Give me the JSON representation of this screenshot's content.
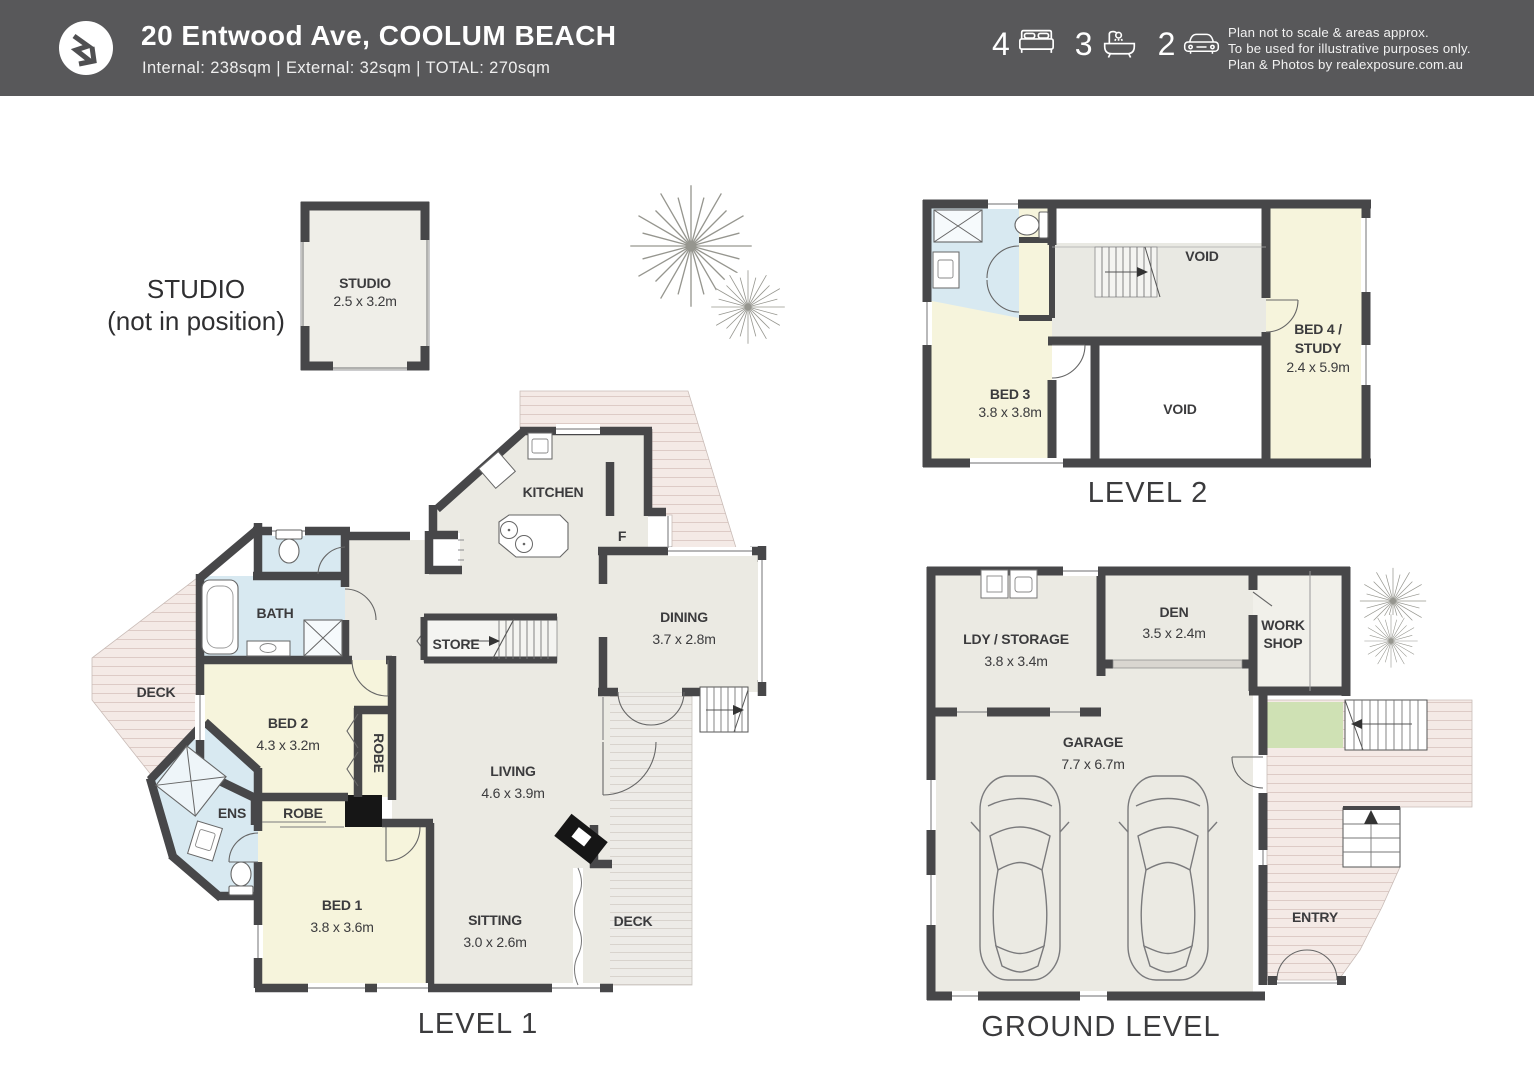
{
  "header": {
    "title": "20 Entwood Ave, COOLUM BEACH",
    "subtitle": "Internal: 238sqm   |   External: 32sqm   |   TOTAL: 270sqm",
    "stats": {
      "beds": "4",
      "baths": "3",
      "cars": "2"
    },
    "disclaimer": [
      "Plan not to scale & areas approx.",
      "To be used for illustrative purposes only.",
      "Plan & Photos by realexposure.com.au"
    ]
  },
  "plans": {
    "studio": {
      "annotation_line1": "STUDIO",
      "annotation_line2": "(not in position)",
      "room": "STUDIO",
      "dims": "2.5 x 3.2m"
    },
    "level1": {
      "title": "LEVEL 1",
      "kitchen": "KITCHEN",
      "fridge": "F",
      "dining": "DINING",
      "dining_dims": "3.7 x 2.8m",
      "store": "STORE",
      "living": "LIVING",
      "living_dims": "4.6 x 3.9m",
      "sitting": "SITTING",
      "sitting_dims": "3.0 x 2.6m",
      "bed1": "BED 1",
      "bed1_dims": "3.8 x 3.6m",
      "bed2": "BED 2",
      "bed2_dims": "4.3 x 3.2m",
      "bath": "BATH",
      "ens": "ENS",
      "robe_bed2": "ROBE",
      "robe_bed1": "ROBE",
      "deck_left": "DECK",
      "deck_right": "DECK"
    },
    "level2": {
      "title": "LEVEL 2",
      "bed3": "BED 3",
      "bed3_dims": "3.8 x 3.8m",
      "bed4_line1": "BED 4 /",
      "bed4_line2": "STUDY",
      "bed4_dims": "2.4 x 5.9m",
      "void_top": "VOID",
      "void_bottom": "VOID"
    },
    "ground": {
      "title": "GROUND LEVEL",
      "ldy": "LDY / STORAGE",
      "ldy_dims": "3.8 x 3.4m",
      "den": "DEN",
      "den_dims": "3.5 x 2.4m",
      "workshop_line1": "WORK",
      "workshop_line2": "SHOP",
      "garage": "GARAGE",
      "garage_dims": "7.7 x 6.7m",
      "entry": "ENTRY"
    }
  },
  "colors": {
    "header_bg": "#58585a",
    "wall": "#474749",
    "room_gray": "#ebeae3",
    "room_cream": "#f6f4dc",
    "room_blue": "#d8e9f1",
    "deck_pink": "#f4eae6",
    "deck_gray": "#edebe7",
    "grass_green": "#cfe1b4",
    "void_white": "#ffffff"
  }
}
